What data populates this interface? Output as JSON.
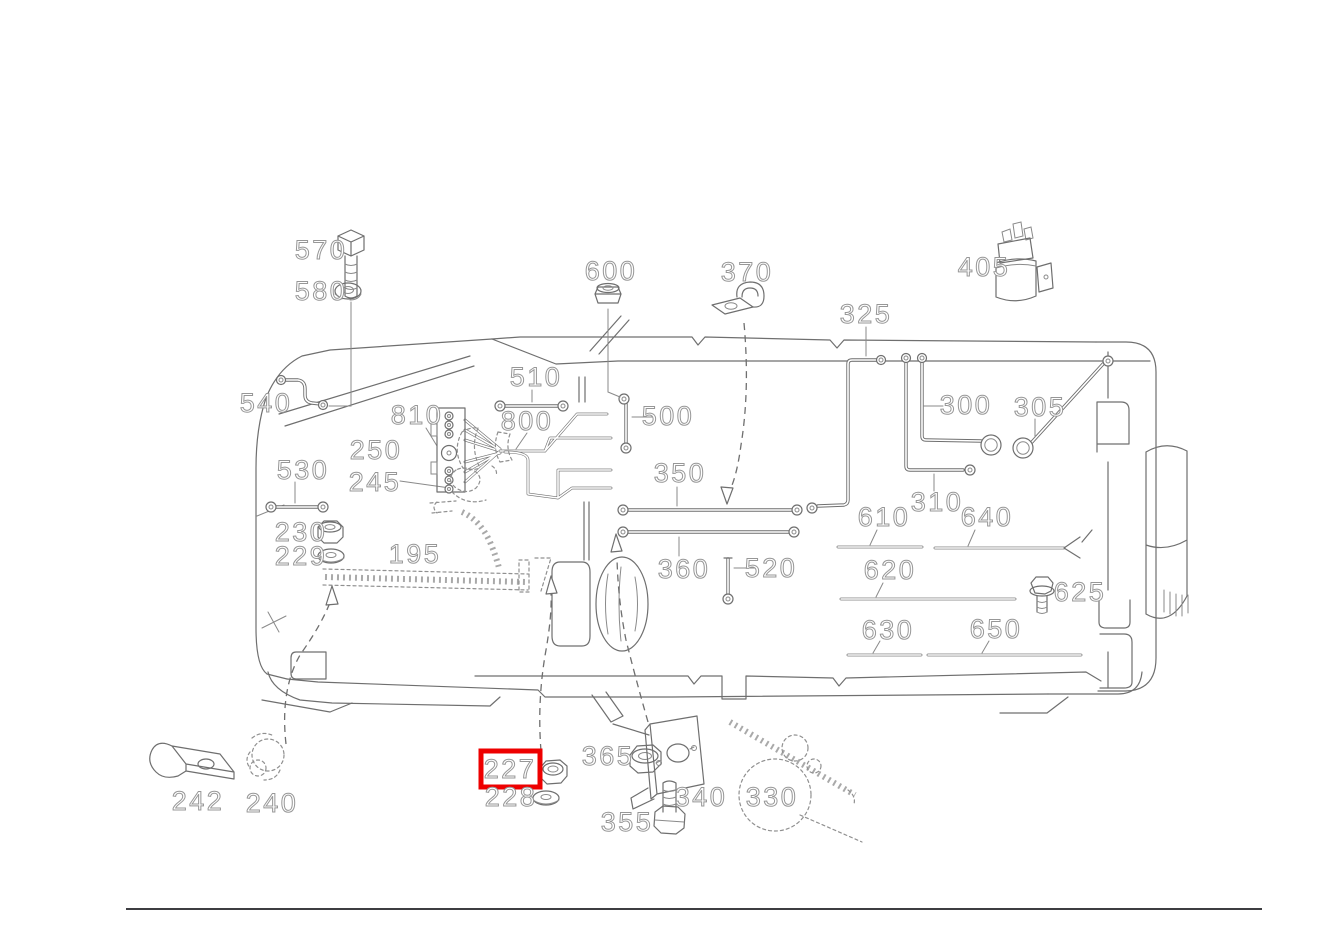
{
  "diagram": {
    "type": "parts-catalog-line-drawing",
    "background_color": "#ffffff",
    "drawing_line_color": "#6f6f6f",
    "label_outline_color": "#979797",
    "highlight": {
      "label": "227",
      "color": "#ee0000",
      "x": 481,
      "y": 751,
      "width": 59,
      "height": 36
    },
    "bottom_rule": {
      "x1": 126,
      "x2": 1262,
      "y": 909,
      "color": "#3d3d41",
      "width": 2
    },
    "part_labels": [
      {
        "text": "570",
        "x": 321,
        "y": 250
      },
      {
        "text": "580",
        "x": 321,
        "y": 291
      },
      {
        "text": "600",
        "x": 611,
        "y": 271
      },
      {
        "text": "370",
        "x": 747,
        "y": 272
      },
      {
        "text": "405",
        "x": 984,
        "y": 267
      },
      {
        "text": "325",
        "x": 866,
        "y": 314
      },
      {
        "text": "540",
        "x": 266,
        "y": 403
      },
      {
        "text": "510",
        "x": 536,
        "y": 377
      },
      {
        "text": "810",
        "x": 417,
        "y": 415
      },
      {
        "text": "800",
        "x": 527,
        "y": 421
      },
      {
        "text": "500",
        "x": 668,
        "y": 416
      },
      {
        "text": "300",
        "x": 966,
        "y": 405
      },
      {
        "text": "305",
        "x": 1040,
        "y": 407
      },
      {
        "text": "250",
        "x": 376,
        "y": 450
      },
      {
        "text": "245",
        "x": 375,
        "y": 482
      },
      {
        "text": "530",
        "x": 303,
        "y": 470
      },
      {
        "text": "350",
        "x": 680,
        "y": 473
      },
      {
        "text": "310",
        "x": 937,
        "y": 502
      },
      {
        "text": "610",
        "x": 884,
        "y": 517
      },
      {
        "text": "640",
        "x": 987,
        "y": 517
      },
      {
        "text": "230",
        "x": 301,
        "y": 532
      },
      {
        "text": "229",
        "x": 301,
        "y": 556
      },
      {
        "text": "195",
        "x": 415,
        "y": 554
      },
      {
        "text": "360",
        "x": 684,
        "y": 569
      },
      {
        "text": "520",
        "x": 771,
        "y": 568
      },
      {
        "text": "620",
        "x": 890,
        "y": 570
      },
      {
        "text": "625",
        "x": 1080,
        "y": 592
      },
      {
        "text": "630",
        "x": 888,
        "y": 630
      },
      {
        "text": "650",
        "x": 996,
        "y": 629
      },
      {
        "text": "242",
        "x": 198,
        "y": 801
      },
      {
        "text": "240",
        "x": 272,
        "y": 803
      },
      {
        "text": "227",
        "x": 510,
        "y": 769,
        "highlighted": true
      },
      {
        "text": "228",
        "x": 511,
        "y": 797
      },
      {
        "text": "365",
        "x": 608,
        "y": 756
      },
      {
        "text": "340",
        "x": 701,
        "y": 797
      },
      {
        "text": "355",
        "x": 627,
        "y": 822
      },
      {
        "text": "330",
        "x": 772,
        "y": 797
      }
    ]
  }
}
